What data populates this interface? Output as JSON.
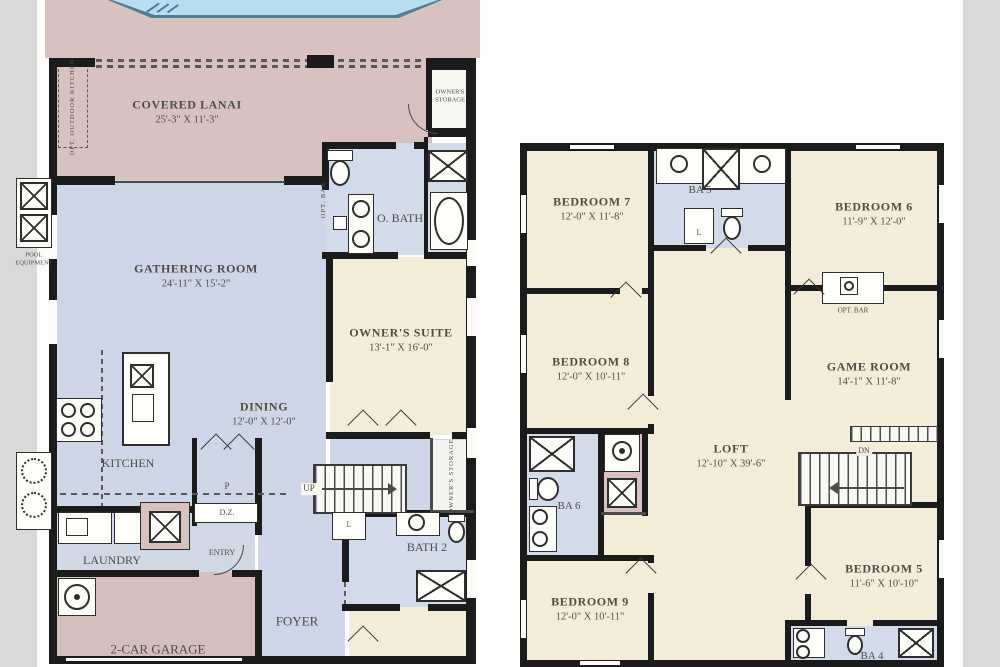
{
  "palette": {
    "deck_mauve": "#d7c2bf",
    "garage_mauve": "#d4bfbc",
    "interior_blue": "#cdd6e6",
    "bath_blue": "#d2dbe9",
    "room_cream": "#f3ecd8",
    "pool_water": "#b7ddee",
    "pool_edge": "#4f7d96",
    "wall_black": "#1b1b1b",
    "label_gray": "#4e4e46",
    "photo_band_gray": "#d9d9d9"
  },
  "floor1": {
    "covered_lanai": {
      "name": "COVERED LANAI",
      "dims": "25'-3\" X 11'-3\""
    },
    "opt_outdoor_kitchen": "OPT. OUTDOOR KITCHEN",
    "owners_storage_top": {
      "line1": "OWNER'S",
      "line2": "STORAGE"
    },
    "pool_equipment": {
      "line1": "POOL",
      "line2": "EQUIPMENT"
    },
    "o_bath": "O. BATH",
    "opt_bar": "OPT. BAR",
    "gathering_room": {
      "name": "GATHERING ROOM",
      "dims": "24'-11\" X 15'-2\""
    },
    "owners_suite": {
      "name": "OWNER'S SUITE",
      "dims": "13'-1\" X 16'-0\""
    },
    "dining": {
      "name": "DINING",
      "dims": "12'-0\" X 12'-0\""
    },
    "kitchen": "KITCHEN",
    "pantry": "P",
    "drop_zone": "D.Z.",
    "laundry": "LAUNDRY",
    "entry": "ENTRY",
    "up": "UP",
    "bath2": "BATH 2",
    "linen": "L",
    "owners_storage_side": "OWNER'S STORAGE",
    "foyer": "FOYER",
    "garage": "2-CAR GARAGE"
  },
  "floor2": {
    "bedroom7": {
      "name": "BEDROOM 7",
      "dims": "12'-0\" X 11'-8\""
    },
    "ba5": "BA 5",
    "linen5": "L",
    "bedroom6": {
      "name": "BEDROOM 6",
      "dims": "11'-9\" X 12'-0\""
    },
    "opt_bar": "OPT. BAR",
    "bedroom8": {
      "name": "BEDROOM 8",
      "dims": "12'-0\" X 10'-11\""
    },
    "game_room": {
      "name": "GAME ROOM",
      "dims": "14'-1\" X 11'-8\""
    },
    "loft": {
      "name": "LOFT",
      "dims": "12'-10\" X 39'-6\""
    },
    "ba6": "BA 6",
    "dn": "DN",
    "bedroom9": {
      "name": "BEDROOM 9",
      "dims": "12'-0\" X 10'-11\""
    },
    "bedroom5": {
      "name": "BEDROOM 5",
      "dims": "11'-6\" X 10'-10\""
    },
    "ba4": "BA 4"
  }
}
